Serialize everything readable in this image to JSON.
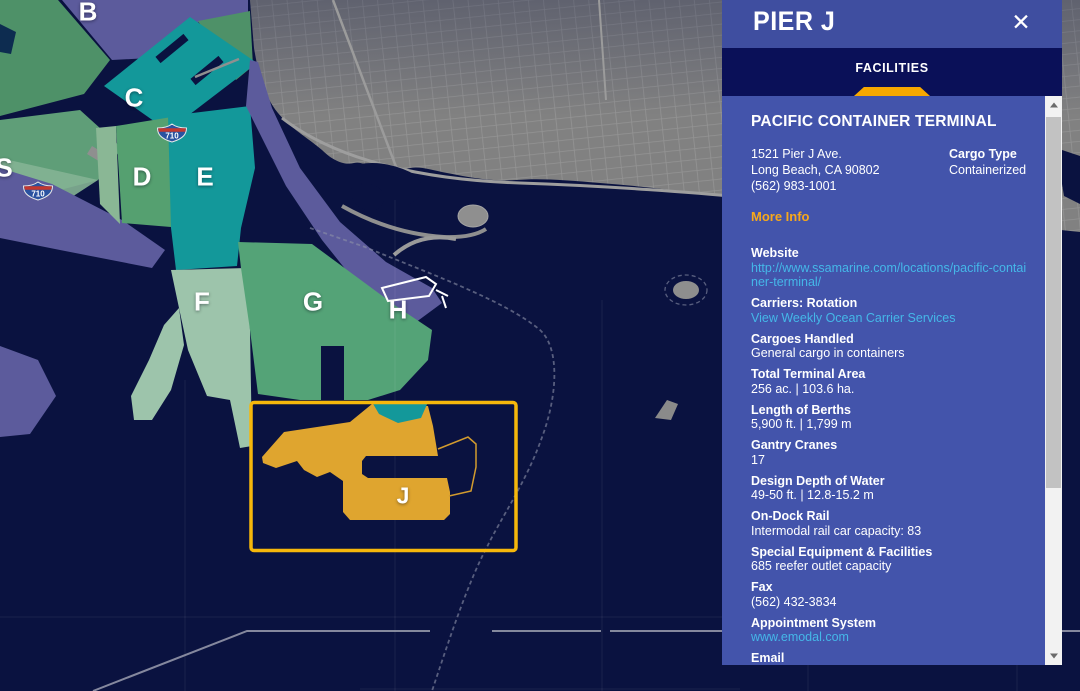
{
  "panel": {
    "title": "PIER J",
    "close_glyph": "✕",
    "tab_label": "FACILITIES",
    "terminal": {
      "name": "PACIFIC CONTAINER TERMINAL",
      "address1": "1521 Pier J Ave.",
      "address2": "Long Beach, CA 90802",
      "phone": "(562) 983-1001",
      "cargo_type_label": "Cargo Type",
      "cargo_type_value": "Containerized",
      "more_info": "More Info"
    },
    "fields": [
      {
        "label": "Website",
        "value": "http://www.ssamarine.com/locations/pacific-container-terminal/",
        "link": true
      },
      {
        "label": "Carriers: Rotation",
        "value": "View Weekly Ocean Carrier Services",
        "link": true
      },
      {
        "label": "Cargoes Handled",
        "value": "General cargo in containers",
        "link": false
      },
      {
        "label": "Total Terminal Area",
        "value": "256 ac. | 103.6 ha.",
        "link": false
      },
      {
        "label": "Length of Berths",
        "value": "5,900 ft. | 1,799 m",
        "link": false
      },
      {
        "label": "Gantry Cranes",
        "value": "17",
        "link": false
      },
      {
        "label": "Design Depth of Water",
        "value": "49-50 ft. | 12.8-15.2 m",
        "link": false
      },
      {
        "label": "On-Dock Rail",
        "value": "Intermodal rail car capacity: 83",
        "link": false
      },
      {
        "label": "Special Equipment & Facilities",
        "value": "685 reefer outlet capacity",
        "link": false
      },
      {
        "label": "Fax",
        "value": "(562) 432-3834",
        "link": false
      },
      {
        "label": "Appointment System",
        "value": "www.emodal.com",
        "link": true
      },
      {
        "label": "Email",
        "value": "Email the terminal",
        "link": true
      }
    ]
  },
  "map": {
    "selected_pier": "J",
    "pier_labels": [
      {
        "label": "B",
        "x": 88,
        "y": 12,
        "size": "big"
      },
      {
        "label": "C",
        "x": 134,
        "y": 98,
        "size": "big"
      },
      {
        "label": "D",
        "x": 142,
        "y": 177,
        "size": "big"
      },
      {
        "label": "E",
        "x": 205,
        "y": 177,
        "size": "big"
      },
      {
        "label": "S",
        "x": 4,
        "y": 168,
        "size": "big"
      },
      {
        "label": "F",
        "x": 202,
        "y": 302,
        "size": "big"
      },
      {
        "label": "G",
        "x": 313,
        "y": 302,
        "size": "big"
      },
      {
        "label": "H",
        "x": 398,
        "y": 310,
        "size": "big"
      },
      {
        "label": "J",
        "x": 403,
        "y": 496,
        "size": "small"
      }
    ],
    "highway_shields": [
      {
        "label": "710",
        "x": 172,
        "y": 133
      },
      {
        "label": "710",
        "x": 38,
        "y": 191
      }
    ],
    "colors": {
      "water": "#0A1240",
      "city_gray": "#818181",
      "pier_purple": "#5C5B9C",
      "pier_teal": "#13989A",
      "pier_green": "#54A377",
      "pier_pale_green": "#9DC4AB",
      "pier_j_orange": "#DFA52F",
      "selection_yellow": "#F6B70B",
      "panel_header": "#3F4EA0",
      "tab_bar": "#0A1058",
      "panel_bg": "#4354AB",
      "accent_orange": "#F7A81B",
      "link_blue": "#45B7E8"
    }
  }
}
